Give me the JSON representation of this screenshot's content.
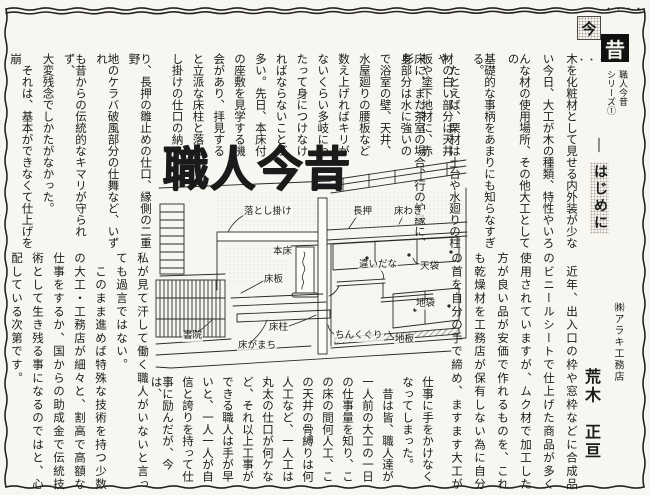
{
  "colors": {
    "paper": "#f8f6f1",
    "ink": "#1b1b1b",
    "black_box": "#111111",
    "halftone": "#b2afa7"
  },
  "header": {
    "dots_top": "・・・・",
    "dots_bottom": "・・・",
    "box_kon": "今",
    "box_jaku": "昔",
    "series_title": "職人今昔",
    "series_no": "シリーズ①",
    "section_dash": "―",
    "section_heading": "はじめに",
    "company": "㈱アラキ工務店",
    "author": "荒木　正亘"
  },
  "big_title": "職人今昔",
  "article1": {
    "cols_right": [
      "木を化粧材として見せる内外装が少な",
      "い今日、大工が木の種類、特性やいろ",
      "んな材の使用場所、その他大工としての",
      "基礎的な事柄をあまりにも知らなすぎる。",
      "　たとえば、栗材は土台や水廻りの柱や",
      "床に、また茶室の場合、行の炉縁に、杉"
    ],
    "cols_mid": [
      "材の白い部分は天井",
      "板や塗下地材に、赤",
      "身部分は水に強いの",
      "で浴室の壁、天井、",
      "水屋廻りの腰板など",
      "数え上げればキリが",
      "ないくらい多岐にわ",
      "たって身につけなけ",
      "ればならないことが",
      "多い。先日、本床付",
      "の座敷を見学する機",
      "会があり、拝見する",
      "と立派な床柱と落と",
      "し掛けの仕口の納ま"
    ],
    "cols_left": [
      "り、長押の雛止めの仕口、縁側の二重野",
      "地のケラバ破風部分の仕舞など、いずれ",
      "も昔からの伝統的なキマリが守られず、",
      "大変残念でしかたがなかった。",
      "　それは、基本ができなくて仕上げを崩",
      "す事は出来上がりがどことなくぎごちな",
      "く、納まりがよくないと言われたものだ。"
    ]
  },
  "article2": {
    "cols_right": [
      "　近年、出入口の枠や窓枠などに合成品",
      "のビニールシートで仕上げた商品が多く",
      "使用されていますが、ムク材で加工した",
      "方が良い品が安価で作れるものを、これ",
      "も乾燥材を工務店が保有しない為に自分",
      "の首を自分の手で締め、ますます大工が"
    ],
    "cols_mid": [
      "仕事に手をかけなく",
      "なってしまった。",
      "　昔は皆、職人達が",
      "一人前の大工の一日",
      "の仕事量を知り、こ",
      "の床の間何人工、こ",
      "の天井の骨縛りは何",
      "人工など、一人工は",
      "丸太の仕口が何ケな",
      "ど、それ以上工事が",
      "できる職人は手が早",
      "いと、一人一人が自",
      "信と誇りを持って仕",
      "事に励んだが、今は、"
    ],
    "cols_left": [
      "私が見て汗して働く職人がいないと言っ",
      "ても過言ではない。",
      "　このまま進めば特殊な技術を持つ少数",
      "の大工・工務店が細々と、割高で高額な",
      "仕事をするか、国からの助成金で伝統技",
      "術として生き残る事になるのではと、心",
      "配している次第です。"
    ]
  },
  "illustration": {
    "labels": [
      {
        "text": "落とし掛け",
        "x": 90,
        "y": 60
      },
      {
        "text": "長押",
        "x": 199,
        "y": 60
      },
      {
        "text": "床わき",
        "x": 240,
        "y": 60
      },
      {
        "text": "本床",
        "x": 119,
        "y": 100
      },
      {
        "text": "違いだな",
        "x": 205,
        "y": 113
      },
      {
        "text": "天袋",
        "x": 266,
        "y": 115
      },
      {
        "text": "地袋",
        "x": 262,
        "y": 152
      },
      {
        "text": "ちんくぐり",
        "x": 181,
        "y": 184
      },
      {
        "text": "地板",
        "x": 241,
        "y": 188
      },
      {
        "text": "床板",
        "x": 110,
        "y": 128
      },
      {
        "text": "床柱",
        "x": 115,
        "y": 176
      },
      {
        "text": "床がまち",
        "x": 84,
        "y": 194
      },
      {
        "text": "書院",
        "x": 29,
        "y": 184
      }
    ]
  }
}
